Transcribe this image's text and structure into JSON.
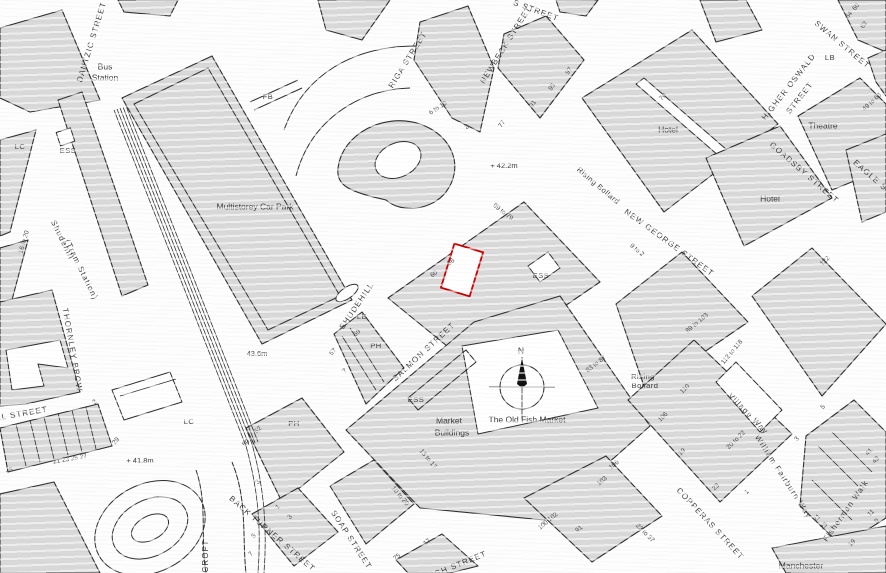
{
  "map": {
    "title": "Site location plan — Shudehill, Manchester",
    "colors": {
      "building": "#d9d9d9",
      "outline": "#2e2e2e",
      "highlight": "#cc0000",
      "label": "#3b3b3b"
    },
    "compass": {
      "label": "N"
    },
    "plot": {
      "x": 447,
      "y": 247,
      "w": 30,
      "h": 46,
      "rotate": 17,
      "stroke": "#cc0000"
    },
    "labels": [
      {
        "t": "DANTZIC STREET",
        "x": 92,
        "y": 42,
        "r": -73,
        "k": "st"
      },
      {
        "t": "RIGA STREET",
        "x": 408,
        "y": 60,
        "r": -58,
        "k": "st"
      },
      {
        "t": "NEWBECK STREET",
        "x": 506,
        "y": 45,
        "r": -58,
        "k": "st"
      },
      {
        "t": "S STREET",
        "x": 536,
        "y": 11,
        "r": 20,
        "k": "st"
      },
      {
        "t": "SWAN STREET",
        "x": 842,
        "y": 45,
        "r": 40,
        "k": "st"
      },
      {
        "t": "HIGHER OSWALD",
        "x": 789,
        "y": 87,
        "r": -52,
        "k": "st"
      },
      {
        "t": "STREET",
        "x": 800,
        "y": 98,
        "r": -52,
        "k": "st"
      },
      {
        "t": "GOADSBY STREET",
        "x": 804,
        "y": 173,
        "r": 41,
        "k": "st"
      },
      {
        "t": "EAGLE STREET",
        "x": 882,
        "y": 186,
        "r": 41,
        "k": "st"
      },
      {
        "t": "NEW GEORGE STREET",
        "x": 669,
        "y": 243,
        "r": 36,
        "k": "st"
      },
      {
        "t": "SHUDEHILL",
        "x": 357,
        "y": 306,
        "r": -56,
        "k": "st"
      },
      {
        "t": "SALMON STREET",
        "x": 424,
        "y": 352,
        "r": -43,
        "k": "st"
      },
      {
        "t": "THORNLEY BROW",
        "x": 72,
        "y": 350,
        "r": 80,
        "k": "st"
      },
      {
        "t": "LL STREET",
        "x": 22,
        "y": 414,
        "r": -10,
        "k": "st"
      },
      {
        "t": "BACK TURNER STREET",
        "x": 272,
        "y": 534,
        "r": 41,
        "k": "st"
      },
      {
        "t": "SOAP STREET",
        "x": 351,
        "y": 540,
        "r": 57,
        "k": "st"
      },
      {
        "t": "HIGH STREET",
        "x": 456,
        "y": 566,
        "r": -22,
        "k": "st"
      },
      {
        "t": "COPPERAS STREET",
        "x": 710,
        "y": 524,
        "r": 47,
        "k": "st"
      },
      {
        "t": "William Fairburn Way",
        "x": 783,
        "y": 477,
        "r": 57,
        "k": "st"
      },
      {
        "t": "Village Way",
        "x": 748,
        "y": 414,
        "r": 46,
        "k": "st"
      },
      {
        "t": "Fisherman Walk",
        "x": 846,
        "y": 511,
        "r": -55,
        "k": "st"
      },
      {
        "t": "CROFT",
        "x": 206,
        "y": 556,
        "r": -90,
        "k": "st"
      },
      {
        "t": "Shudehill",
        "x": 62,
        "y": 240,
        "r": 64,
        "k": "st"
      },
      {
        "t": "(Tram Station)",
        "x": 81,
        "y": 270,
        "r": 64,
        "k": "st"
      },
      {
        "t": "Bus",
        "x": 105,
        "y": 67,
        "k": "pl"
      },
      {
        "t": "Station",
        "x": 105,
        "y": 78,
        "k": "pl"
      },
      {
        "t": "Multistorey Car Park",
        "x": 255,
        "y": 207,
        "k": "pl"
      },
      {
        "t": "Hotel",
        "x": 668,
        "y": 130,
        "k": "pl"
      },
      {
        "t": "Hotel",
        "x": 770,
        "y": 199,
        "k": "pl"
      },
      {
        "t": "Theatre",
        "x": 823,
        "y": 126,
        "k": "pl"
      },
      {
        "t": "Market",
        "x": 449,
        "y": 421,
        "k": "pl"
      },
      {
        "t": "Buildings",
        "x": 452,
        "y": 433,
        "k": "pl"
      },
      {
        "t": "The Old Fish Market",
        "x": 527,
        "y": 420,
        "k": "pl"
      },
      {
        "t": "Manchester",
        "x": 801,
        "y": 566,
        "k": "pl"
      },
      {
        "t": "Rising Bollard",
        "x": 598,
        "y": 186,
        "r": 40,
        "k": "cd"
      },
      {
        "t": "Rising",
        "x": 643,
        "y": 377,
        "k": "cd"
      },
      {
        "t": "Bollard",
        "x": 645,
        "y": 386,
        "k": "cd"
      },
      {
        "t": "N",
        "x": 521,
        "y": 351,
        "s": 11,
        "k": "pl"
      },
      {
        "t": "ESS",
        "x": 68,
        "y": 151,
        "k": "cd"
      },
      {
        "t": "ESS",
        "x": 541,
        "y": 276,
        "k": "cd"
      },
      {
        "t": "ESS",
        "x": 416,
        "y": 400,
        "k": "cd"
      },
      {
        "t": "LC",
        "x": 20,
        "y": 147,
        "k": "cd"
      },
      {
        "t": "LC",
        "x": 189,
        "y": 422,
        "k": "cd"
      },
      {
        "t": "FB",
        "x": 268,
        "y": 97,
        "k": "cd"
      },
      {
        "t": "PH",
        "x": 376,
        "y": 346,
        "k": "cd"
      },
      {
        "t": "PH",
        "x": 294,
        "y": 424,
        "k": "cd"
      },
      {
        "t": "LB",
        "x": 830,
        "y": 58,
        "k": "cd"
      },
      {
        "t": "LB",
        "x": 362,
        "y": 317,
        "k": "cd"
      },
      {
        "t": "+ 42.2m",
        "x": 504,
        "y": 166,
        "k": "el"
      },
      {
        "t": "43.6m",
        "x": 257,
        "y": 354,
        "k": "el"
      },
      {
        "t": "+ 41.8m",
        "x": 140,
        "y": 461,
        "k": "el"
      },
      {
        "t": "6 to 10",
        "x": 438,
        "y": 108,
        "r": -33,
        "k": "nm"
      },
      {
        "t": "2",
        "x": 467,
        "y": 127,
        "r": -33,
        "k": "nm"
      },
      {
        "t": "77",
        "x": 502,
        "y": 124,
        "r": -55,
        "k": "nm"
      },
      {
        "t": "91",
        "x": 533,
        "y": 104,
        "r": -55,
        "k": "nm"
      },
      {
        "t": "95",
        "x": 552,
        "y": 87,
        "r": -55,
        "k": "nm"
      },
      {
        "t": "97",
        "x": 569,
        "y": 71,
        "r": -55,
        "k": "nm"
      },
      {
        "t": "70",
        "x": 663,
        "y": 97,
        "r": -45,
        "k": "nm"
      },
      {
        "t": "60",
        "x": 856,
        "y": 7,
        "r": -50,
        "k": "nm"
      },
      {
        "t": "64",
        "x": 849,
        "y": 15,
        "r": -50,
        "k": "nm"
      },
      {
        "t": "62",
        "x": 864,
        "y": 25,
        "r": -50,
        "k": "nm"
      },
      {
        "t": "49 to 63",
        "x": 872,
        "y": 102,
        "r": -43,
        "k": "nm"
      },
      {
        "t": "99 to 79",
        "x": 503,
        "y": 212,
        "r": 38,
        "k": "nm"
      },
      {
        "t": "9 to 2",
        "x": 637,
        "y": 250,
        "r": 40,
        "k": "nm"
      },
      {
        "t": "56",
        "x": 451,
        "y": 262,
        "r": -40,
        "k": "nm"
      },
      {
        "t": "60",
        "x": 434,
        "y": 274,
        "r": -40,
        "k": "nm"
      },
      {
        "t": "89 to 103",
        "x": 697,
        "y": 323,
        "r": -40,
        "k": "nm"
      },
      {
        "t": "83 to 87",
        "x": 596,
        "y": 364,
        "r": -38,
        "k": "nm"
      },
      {
        "t": "112 to 118",
        "x": 732,
        "y": 352,
        "r": -50,
        "k": "nm"
      },
      {
        "t": "110",
        "x": 685,
        "y": 389,
        "r": -45,
        "k": "nm"
      },
      {
        "t": "106",
        "x": 663,
        "y": 417,
        "r": -45,
        "k": "nm"
      },
      {
        "t": "19",
        "x": 682,
        "y": 452,
        "r": -45,
        "k": "nm"
      },
      {
        "t": "20 to 22",
        "x": 736,
        "y": 440,
        "r": -45,
        "k": "nm"
      },
      {
        "t": "3",
        "x": 797,
        "y": 439,
        "r": -45,
        "k": "nm"
      },
      {
        "t": "5",
        "x": 823,
        "y": 407,
        "r": -45,
        "k": "nm"
      },
      {
        "t": "122",
        "x": 825,
        "y": 261,
        "r": -45,
        "k": "nm"
      },
      {
        "t": "41",
        "x": 869,
        "y": 452,
        "r": -45,
        "k": "nm"
      },
      {
        "t": "43",
        "x": 876,
        "y": 460,
        "r": -45,
        "k": "nm"
      },
      {
        "t": "21",
        "x": 817,
        "y": 518,
        "r": -45,
        "k": "nm"
      },
      {
        "t": "23",
        "x": 824,
        "y": 526,
        "r": -45,
        "k": "nm"
      },
      {
        "t": "11",
        "x": 871,
        "y": 513,
        "r": -45,
        "k": "nm"
      },
      {
        "t": "9",
        "x": 877,
        "y": 521,
        "r": -45,
        "k": "nm"
      },
      {
        "t": "19",
        "x": 852,
        "y": 543,
        "r": -45,
        "k": "nm"
      },
      {
        "t": "23 to 37",
        "x": 645,
        "y": 533,
        "r": 45,
        "k": "nm"
      },
      {
        "t": "23",
        "x": 716,
        "y": 487,
        "r": -45,
        "k": "nm"
      },
      {
        "t": "1",
        "x": 747,
        "y": 492,
        "r": -45,
        "k": "nm"
      },
      {
        "t": "13 to 17",
        "x": 428,
        "y": 459,
        "r": 50,
        "k": "nm"
      },
      {
        "t": "10 to 20",
        "x": 400,
        "y": 496,
        "r": 50,
        "k": "nm"
      },
      {
        "t": "100 102",
        "x": 548,
        "y": 521,
        "r": -40,
        "k": "nm"
      },
      {
        "t": "91",
        "x": 579,
        "y": 529,
        "r": -40,
        "k": "nm"
      },
      {
        "t": "103",
        "x": 602,
        "y": 481,
        "r": -40,
        "k": "nm"
      },
      {
        "t": "106",
        "x": 614,
        "y": 465,
        "r": -40,
        "k": "nm"
      },
      {
        "t": "75",
        "x": 397,
        "y": 557,
        "r": -40,
        "k": "nm"
      },
      {
        "t": "17",
        "x": 427,
        "y": 542,
        "r": -40,
        "k": "nm"
      },
      {
        "t": "16 to 20",
        "x": 24,
        "y": 242,
        "r": -74,
        "k": "nm"
      },
      {
        "t": "15",
        "x": 9,
        "y": 470,
        "k": "nm"
      },
      {
        "t": "21 23 25 27",
        "x": 70,
        "y": 459,
        "r": -10,
        "k": "nm"
      },
      {
        "t": "29",
        "x": 116,
        "y": 441,
        "r": -52,
        "k": "nm"
      },
      {
        "t": "2",
        "x": 95,
        "y": 402,
        "r": -45,
        "k": "nm"
      },
      {
        "t": "50",
        "x": 246,
        "y": 443,
        "r": -45,
        "k": "nm"
      },
      {
        "t": "52",
        "x": 258,
        "y": 430,
        "r": -45,
        "k": "nm"
      },
      {
        "t": "1",
        "x": 278,
        "y": 507,
        "r": -45,
        "k": "nm"
      },
      {
        "t": "3",
        "x": 290,
        "y": 517,
        "r": -45,
        "k": "nm"
      },
      {
        "t": "3",
        "x": 258,
        "y": 482,
        "r": -45,
        "k": "nm"
      },
      {
        "t": "5",
        "x": 254,
        "y": 536,
        "r": -45,
        "k": "nm"
      },
      {
        "t": "7",
        "x": 251,
        "y": 554,
        "r": -45,
        "k": "nm"
      },
      {
        "t": "59",
        "x": 357,
        "y": 333,
        "r": -45,
        "k": "nm"
      },
      {
        "t": "57",
        "x": 333,
        "y": 352,
        "r": -45,
        "k": "nm"
      },
      {
        "t": "7",
        "x": 345,
        "y": 371,
        "r": -45,
        "k": "nm"
      }
    ]
  }
}
